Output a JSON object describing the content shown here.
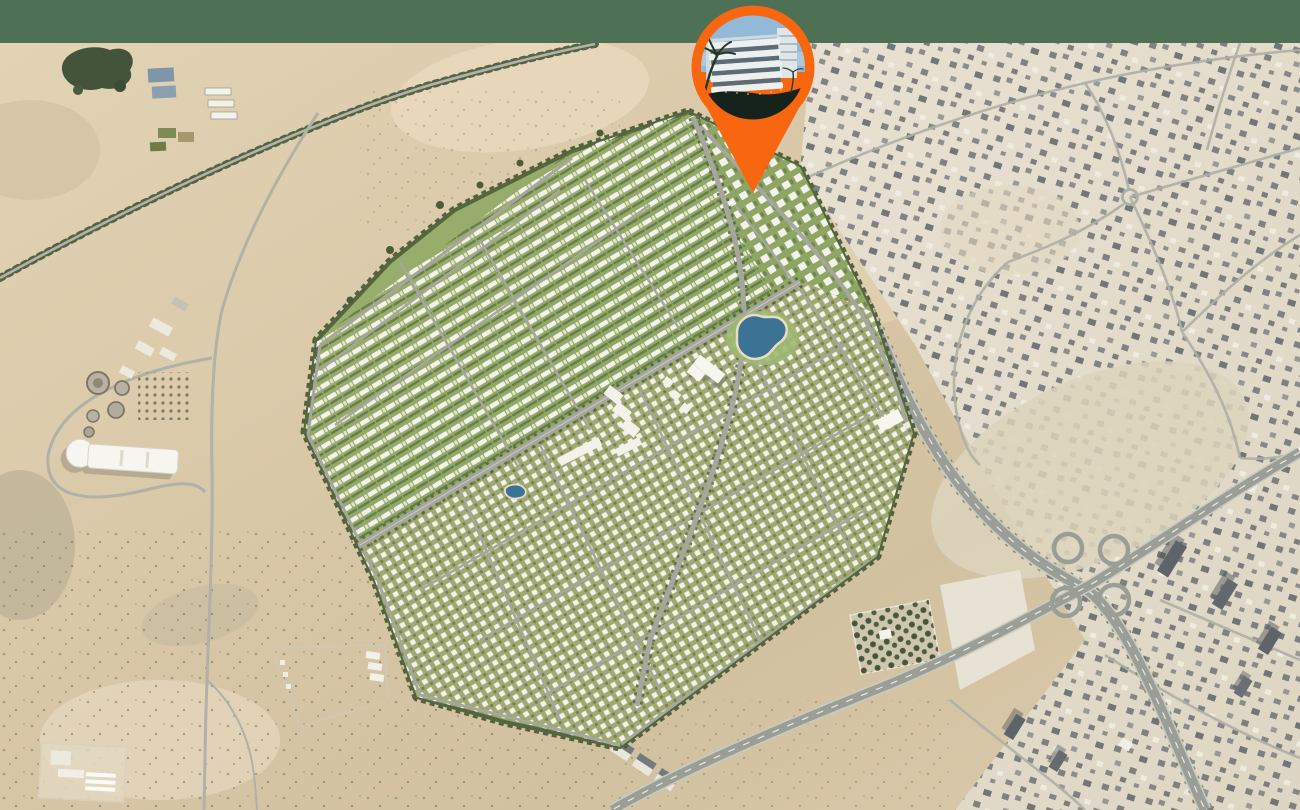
{
  "page": {
    "title": "Masterplan location aerial map",
    "canvas_width_px": 1300,
    "canvas_height_px": 810,
    "visible_text": "none"
  },
  "header_band": {
    "color": "#4e7156",
    "height_px": 43
  },
  "location_pin": {
    "shape": "teardrop map marker",
    "color": "#f8670f",
    "tip_x": 753,
    "tip_y": 193,
    "photo_subject": "apartment-building-render",
    "photo_colors": {
      "sky": "#93b9d8",
      "building": "#edf0f1",
      "windows": "#5c6b74",
      "ground": "#16231d",
      "palm": "#243826",
      "accent_lights": "#e8bc72"
    }
  },
  "map": {
    "style": "satellite-aerial-desert",
    "terrain": {
      "desert_light": "#e3d4b6",
      "desert_mid": "#d9c8a8",
      "desert_dark": "#d2c1a0",
      "desert_warm": "#ead9bf",
      "urban_light": "#e8e1d2",
      "urban_mid": "#ded6c3"
    },
    "roads": {
      "highway": "#9b9d97",
      "highway_casing": "#c9cac3",
      "street": "#aeafa6",
      "lane_marking": "#e9e9e3"
    },
    "development": {
      "label": "gated masterplan community",
      "greenery_light": "#9fb272",
      "greenery_mid": "#8ea564",
      "tree_border": "#4c5c38",
      "villa_white": "#f3f2ea",
      "street": "#a6a79c",
      "lake_color": "#3c7394",
      "beach_edge": "#e7ddc4"
    },
    "features": [
      {
        "id": "green-header-band"
      },
      {
        "id": "location-pin"
      },
      {
        "id": "masterplan-community"
      },
      {
        "id": "large-lake"
      },
      {
        "id": "small-pond"
      },
      {
        "id": "clubhouse-buildings"
      },
      {
        "id": "tree-lined-road"
      },
      {
        "id": "water-treatment-plant"
      },
      {
        "id": "white-landmark-building"
      },
      {
        "id": "forest-grove"
      },
      {
        "id": "farm-plots"
      },
      {
        "id": "cloverleaf-interchange"
      },
      {
        "id": "urban-district"
      },
      {
        "id": "roundabout"
      },
      {
        "id": "walled-compounds"
      },
      {
        "id": "desert-terrain"
      }
    ]
  }
}
